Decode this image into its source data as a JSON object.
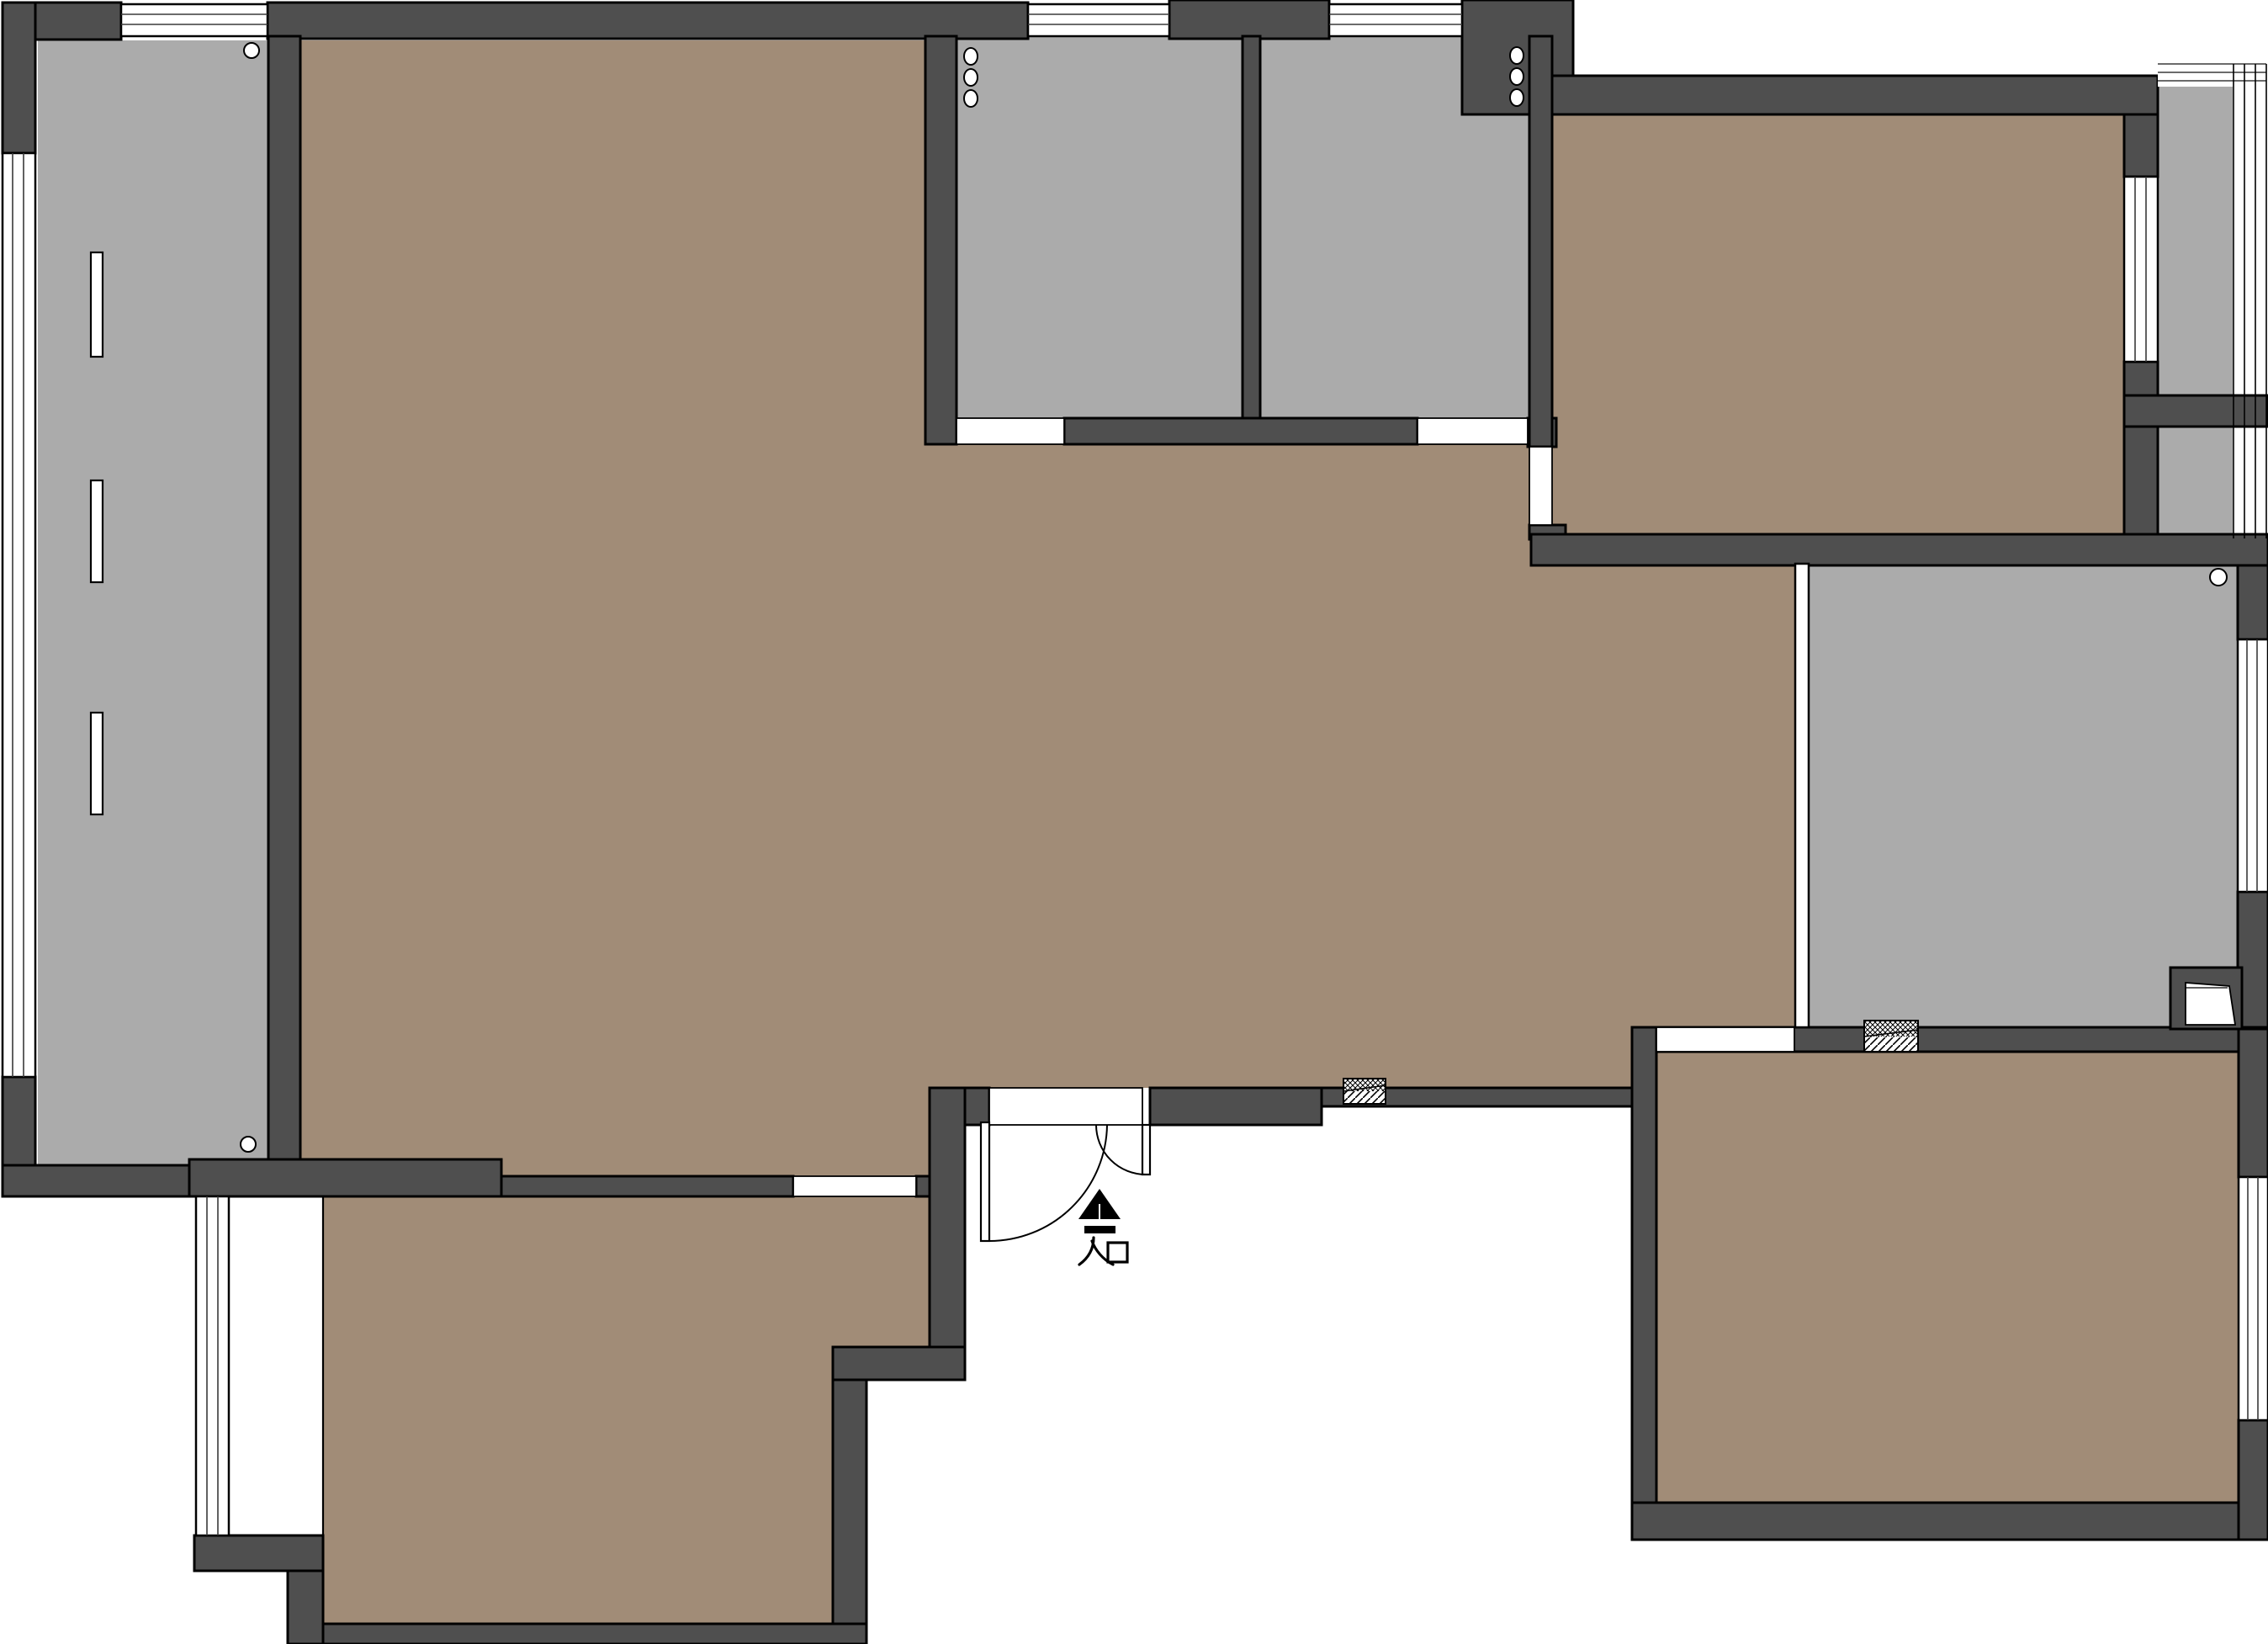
{
  "plan": {
    "type": "residential-floor-plan",
    "entrance": {
      "label": "入口",
      "arrow_icon": "up-arrow"
    },
    "colors": {
      "wall": "#4f4f4f",
      "wood": "#a18c77",
      "gray": "#ababab",
      "line": "#000000",
      "bg": "#ffffff",
      "winline": "#3a3a3a"
    }
  }
}
